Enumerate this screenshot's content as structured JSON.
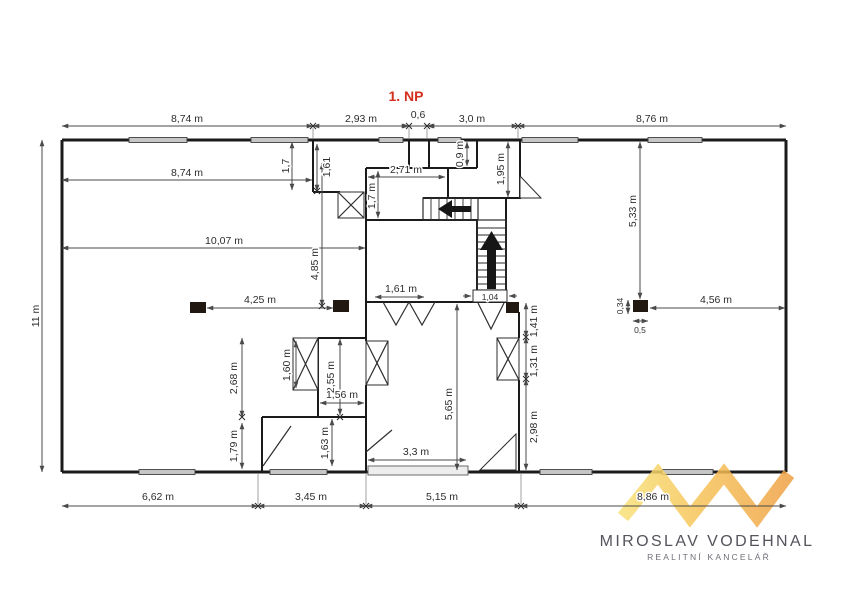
{
  "title": "1. NP",
  "colors": {
    "title_red": "#d5301d",
    "wall": "#1b1b1b",
    "dimension": "#4a4a4a",
    "window_fill": "#c6c6c6",
    "column_fill": "#211911",
    "logo_yellow": "#f8e078",
    "logo_orange": "#efa145",
    "logo_text": "#55545c",
    "logo_tagline": "#6f6e76"
  },
  "dims": {
    "top_8_74": "8,74 m",
    "top_2_93": "2,93 m",
    "top_0_6": "0,6",
    "top_3_0": "3,0 m",
    "top_8_76": "8,76 m",
    "left_11": "11 m",
    "hall_8_74": "8,74 m",
    "hall_1_7": "1,7",
    "hall_1_61": "1,61",
    "hall_10_07": "10,07 m",
    "hall_4_85": "4,85 m",
    "hall_4_25": "4,25 m",
    "hall_2_68": "2,68 m",
    "hall_1_79": "1,79 m",
    "room_c_2_71": "2,71 m",
    "room_c_1_7": "1,7 m",
    "shaft_0_9": "0,9 m",
    "room_e_1_95": "1,95 m",
    "stair_1_04": "1,04",
    "mid_1_61": "1,61 m",
    "mid_5_65": "5,65 m",
    "mid_3_3": "3,3 m",
    "right_wall_1_41": "1,41 m",
    "right_wall_1_31": "1,31 m",
    "right_wall_2_98": "2,98 m",
    "room_a_1_60": "1,60 m",
    "room_a_2_55": "2,55 m",
    "room_a_1_56": "1,56 m",
    "room_b_1_63": "1,63 m",
    "right_5_33": "5,33 m",
    "right_4_56": "4,56 m",
    "col_0_34": "0,34",
    "col_0_5": "0,5",
    "bottom_6_62": "6,62 m",
    "bottom_3_45": "3,45 m",
    "bottom_5_15": "5,15 m",
    "bottom_8_86": "8,86 m"
  },
  "logo": {
    "monogram": "MV",
    "name": "MIROSLAV VODEHNAL",
    "tagline": "REALITNÍ KANCELÁŘ"
  }
}
